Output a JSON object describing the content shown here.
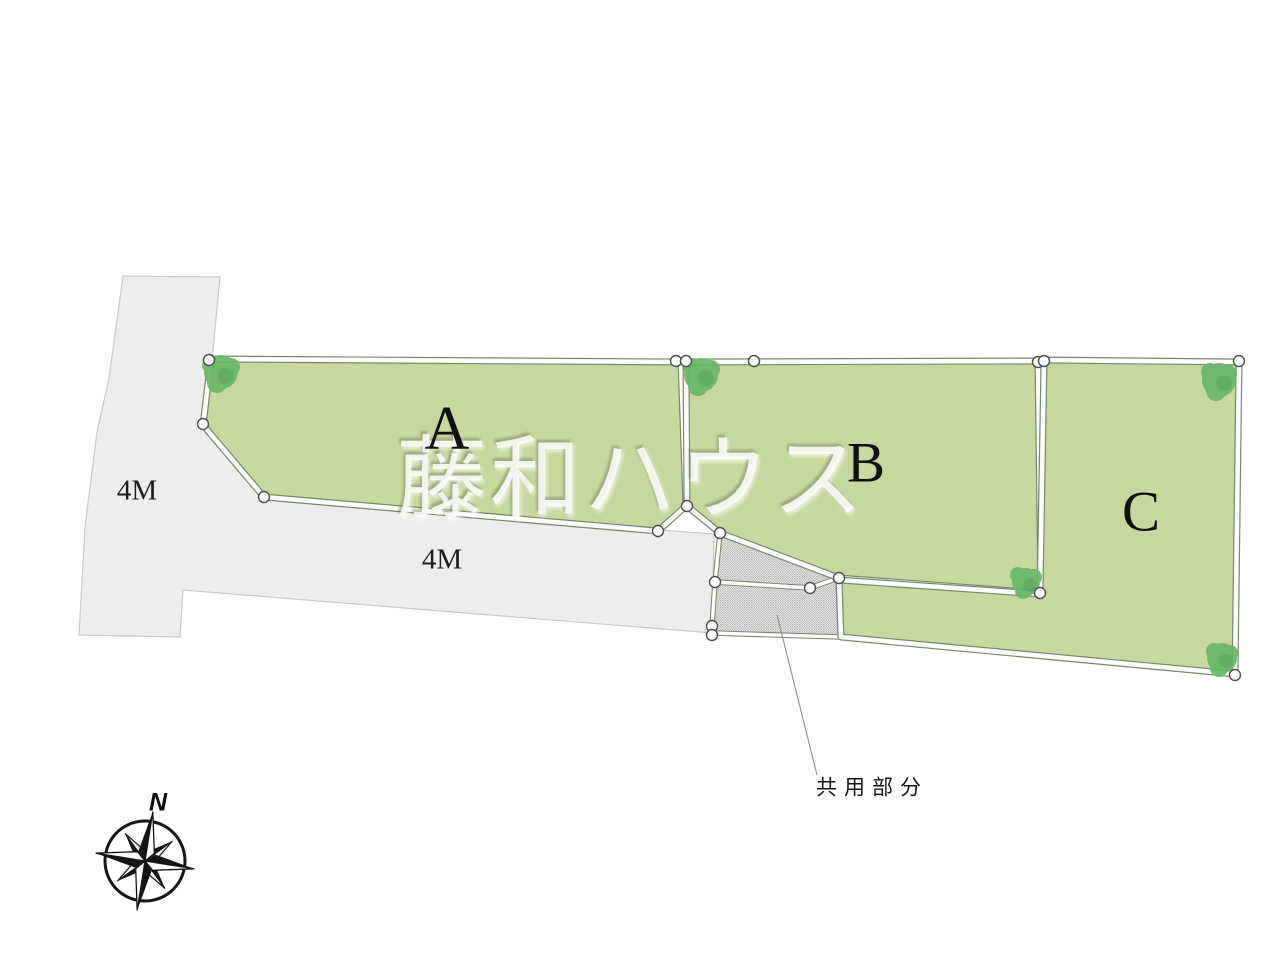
{
  "plan": {
    "watermark": "藤和ハウス",
    "lots": [
      {
        "id": "A",
        "label": "A"
      },
      {
        "id": "B",
        "label": "B"
      },
      {
        "id": "C",
        "label": "C"
      }
    ],
    "roads": [
      {
        "label": "4M",
        "orientation": "vertical"
      },
      {
        "label": "4M",
        "orientation": "horizontal"
      }
    ],
    "common_area": {
      "label": "共用部分"
    },
    "compass": {
      "north_label": "N"
    },
    "colors": {
      "lot_fill": "#c7d89e",
      "tree_green": "#68b566",
      "road_fill": "#ededee",
      "boundary_dark": "#76876a",
      "boundary_white": "#fdfdfb",
      "hatch_dot": "#9b9b9b",
      "watermark": "#ffffff"
    }
  }
}
